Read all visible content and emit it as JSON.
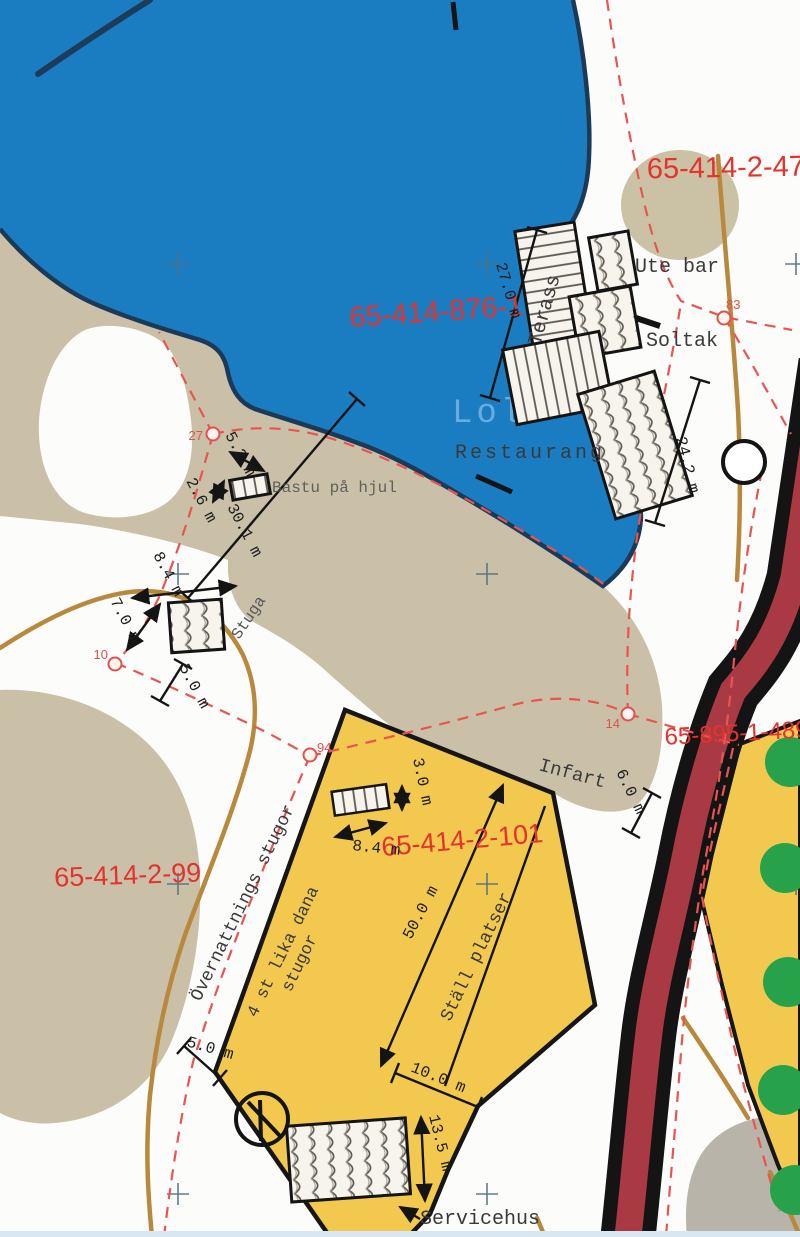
{
  "map": {
    "parcel_labels": {
      "p_414_2_47": "65-414-2-47",
      "p_414_876_1": "65-414-876-1",
      "p_895_1_489": "65-895-1-489",
      "p_414_2_99": "65-414-2-99",
      "p_414_2_101": "65-414-2-101"
    },
    "place_labels": {
      "ute_bar": "Ute bar",
      "soltak": "Soltak",
      "terass": "Terass",
      "restaurang": "Restaurang",
      "bastu_pa_hjul": "Bastu på hjul",
      "stuga": "Stuga",
      "infart": "Infart",
      "overnattnings_stugor": "Övernattnings stugor",
      "lika_dana_line1": "4 st lika dana",
      "lika_dana_line2": "stugor",
      "stall_platser": "Ställ platser",
      "servicehus": "Servicehus",
      "water_watermark": "Lolo"
    },
    "dimension_labels": {
      "terass_length": "27.0 m",
      "restaurant_side": "24.2 m",
      "bastu_width": "5.2 m",
      "bastu_depth": "2.6 m",
      "shore_dim": "30.1 m",
      "stuga_top": "8.4 m",
      "stuga_side": "7.0 m",
      "stuga_offset": "5.0 m",
      "camp_stuga_depth": "3.0 m",
      "camp_stuga_width": "8.4 m",
      "stall_length": "50.0 m",
      "road_offset": "6.0 m",
      "corner_offset": "5.0 m",
      "stall_end_width": "10.0 m",
      "servicehus_side": "13.5 m"
    },
    "survey_nodes": {
      "n27": "27",
      "n10": "10",
      "n94": "94",
      "n83": "83",
      "n14": "14"
    },
    "colors": {
      "water": "#1a7dc2",
      "sand": "#c9c0a7",
      "gray_land": "#b9b4a9",
      "camp_yellow": "#f2c84f",
      "road_red": "#a93a44",
      "path_brown": "#b8893c",
      "boundary_red": "#ea5450",
      "parcel_red": "#e4322e",
      "tree_green": "#27a24b"
    }
  }
}
